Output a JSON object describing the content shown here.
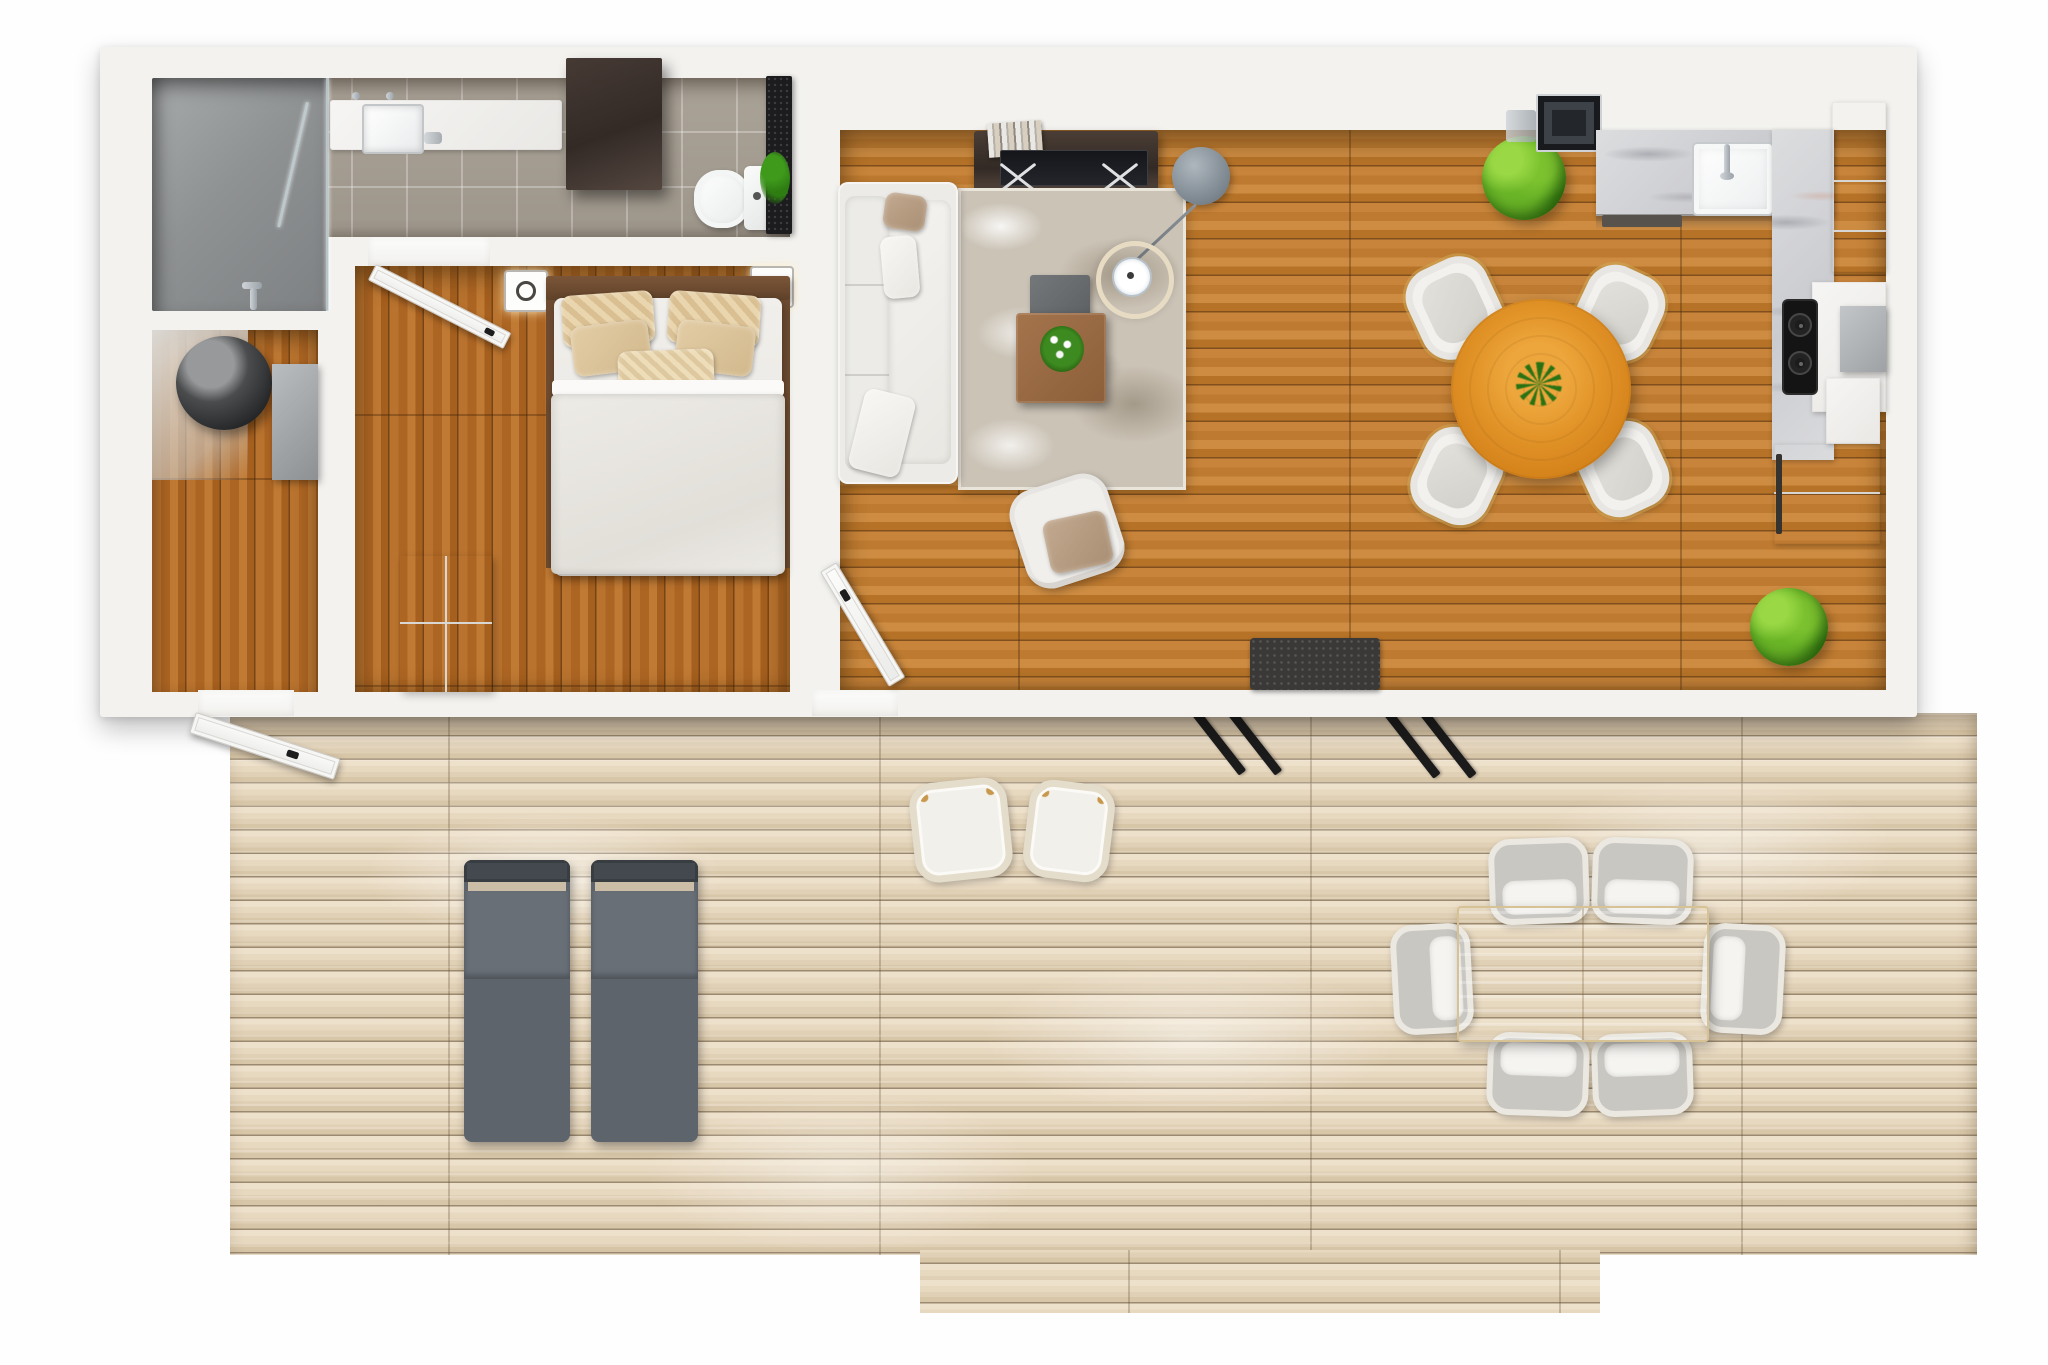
{
  "meta": {
    "type": "3d-floor-plan-top-view",
    "description": "Top-down 3D architectural rendering of a small one-bedroom house with bathroom, entry, bedroom, open living-dining-kitchen, and a large weathered wooden deck with outdoor furniture",
    "no_visible_text": true
  },
  "palette": {
    "wall": "#f3f2ef",
    "wood": "#c07a30",
    "bedroom-wood": "#b26c27",
    "deck": "#e8dac3",
    "tile": "#a69e92",
    "shower": "#97999a",
    "marble": "#d4d5d7",
    "rug": "#cbc3b6",
    "cabinet-dark": "#3a2f2b",
    "walnut": "#6a4a33",
    "orange-table": "#dd8c28",
    "plant": "#67b42c",
    "lounger": "#5d646b",
    "taupe": "#b49a82",
    "charcoal": "#2e2d2c"
  },
  "rooms": [
    {
      "id": "bathroom",
      "label": "Bathroom",
      "items": [
        "shower with glass screen",
        "vanity counter with sink and faucet",
        "dark wall cabinet",
        "toilet",
        "dark stone partition with plant"
      ]
    },
    {
      "id": "entry-utility",
      "label": "Entry / Utility room",
      "items": [
        "cylindrical water heater",
        "gray storage cabinet",
        "door open onto deck"
      ]
    },
    {
      "id": "bedroom",
      "label": "Bedroom",
      "items": [
        "double bed with walnut headboard",
        "five beige pillows",
        "white duvet",
        "white wardrobe",
        "two wall lights",
        "open door"
      ]
    },
    {
      "id": "living-dining-kitchen",
      "label": "Living / Dining / Kitchen",
      "items": [
        "white sofa",
        "mottled area rug",
        "wood and gray coffee tables with orchid",
        "arc floor lamp with ring shade",
        "media console with TV and books",
        "white armchair with taupe throw",
        "round orange dining table with centerpiece",
        "four white dining chairs",
        "marble counter with sink and faucet",
        "dark range hood panel",
        "two-burner cooktop",
        "white cabinets",
        "stone block",
        "two green plants",
        "charcoal doormat",
        "door open to deck"
      ]
    },
    {
      "id": "deck",
      "label": "Wooden deck",
      "items": [
        "two gray sun loungers",
        "two rope lounge chairs with white cushions",
        "rectangular outdoor dining table",
        "six woven outdoor chairs with cushions",
        "open white entry door",
        "black sliding-door tracks"
      ]
    }
  ],
  "counts": {
    "indoor_dining_chairs": 4,
    "outdoor_dining_chairs": 6,
    "sun_loungers": 2,
    "rope_chairs": 2,
    "plants": 3,
    "open_doors": 3,
    "wall_lights": 2,
    "bed_pillows": 5
  }
}
